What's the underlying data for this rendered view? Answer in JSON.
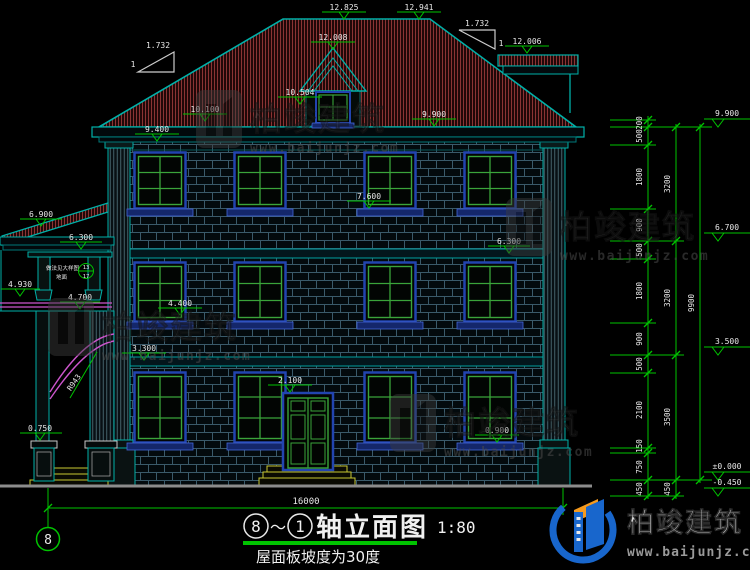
{
  "labels": {
    "ridge_left": "12.825",
    "ridge_right": "12.941",
    "dormer_top": "12.008",
    "side_roof_top": "12.006",
    "roof_left": "10.100",
    "dormer_eave": "10.504",
    "eave_right": "9.900",
    "wall_top_left": "9.400",
    "sill_f3": "7.600",
    "porch_roof": "6.900",
    "porch_eave": "6.300",
    "band_f2": "6.300",
    "porch_rail": "4.930",
    "porch_beam": "4.700",
    "sill_f2": "4.400",
    "band_f1": "3.300",
    "door_top": "2.100",
    "sill_f1": "0.900",
    "porch_base": "0.750",
    "slope_value": "1.732",
    "slope_one": "1",
    "arch_radius": "R943",
    "note_line1": "做法见大样图",
    "note_line2": "地面",
    "detail_num": "13",
    "detail_sheet": "17"
  },
  "right_dims": {
    "chain_inner": [
      "200",
      "500",
      "1800",
      "900",
      "500",
      "1800",
      "900",
      "500",
      "2100",
      "150",
      "750",
      "450"
    ],
    "chain_mid": [
      "3200",
      "3200",
      "3500",
      "450"
    ],
    "chain_total": "9900",
    "level_marks": [
      "9.900",
      "6.700",
      "3.500",
      "±0.000",
      "-0.450"
    ]
  },
  "bottom": {
    "width_total": "16000",
    "axis_bubble": "8",
    "title_from": "8",
    "title_tilde": "～",
    "title_to": "1",
    "title_name": "轴立面图",
    "title_scale": "1:80",
    "subtitle": "屋面板坡度为30度"
  },
  "branding": {
    "name": "柏竣建筑",
    "url": "www.baijunjz.com"
  },
  "colors": {
    "dimension_green": "#00c400",
    "outline_teal": "#00b0a8",
    "roof_red": "#8a3434",
    "window_green": "#3aa43a",
    "frame_blue": "#2244b0",
    "arch_magenta": "#cc55cc",
    "step_yellow": "#c8c832"
  }
}
